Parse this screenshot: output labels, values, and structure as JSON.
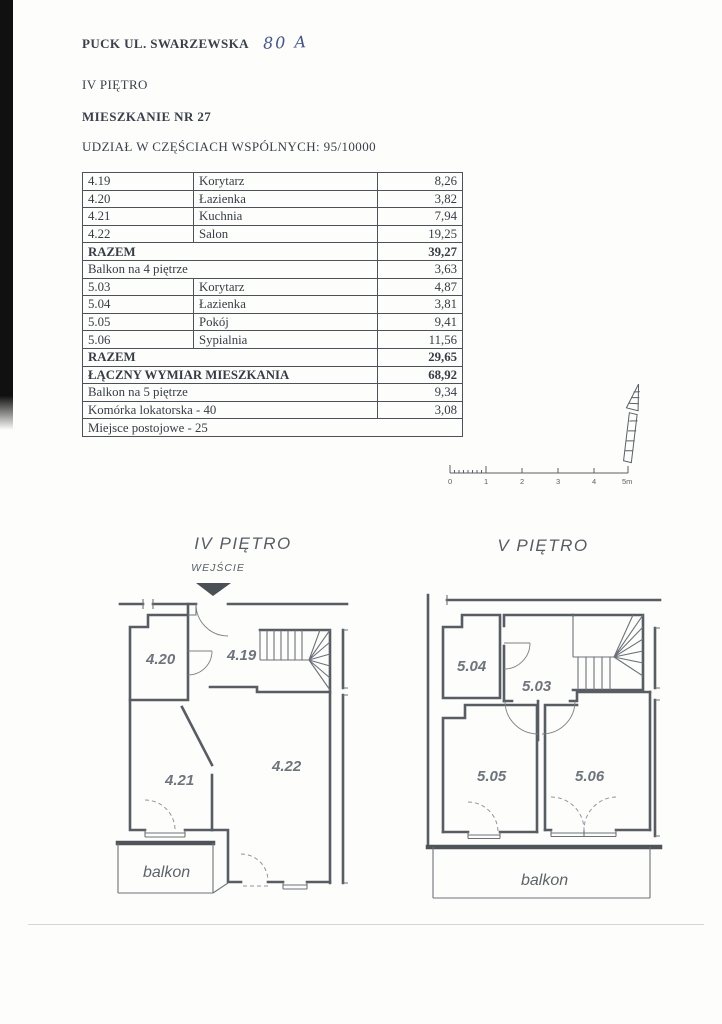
{
  "header": {
    "address_printed": "PUCK UL. SWARZEWSKA",
    "address_handwritten": "80 A",
    "floor_line": "IV PIĘTRO",
    "apartment_line": "MIESZKANIE NR 27",
    "share_line": "UDZIAŁ W CZĘŚCIACH WSPÓLNYCH: 95/10000"
  },
  "area_table": {
    "rows": [
      {
        "no": "4.19",
        "name": "Korytarz",
        "area": "8,26"
      },
      {
        "no": "4.20",
        "name": "Łazienka",
        "area": "3,82"
      },
      {
        "no": "4.21",
        "name": "Kuchnia",
        "area": "7,94"
      },
      {
        "no": "4.22",
        "name": "Salon",
        "area": "19,25"
      },
      {
        "label": "RAZEM",
        "area": "39,27"
      },
      {
        "label": "Balkon na 4 piętrze",
        "area": "3,63"
      },
      {
        "no": "5.03",
        "name": "Korytarz",
        "area": "4,87"
      },
      {
        "no": "5.04",
        "name": "Łazienka",
        "area": "3,81"
      },
      {
        "no": "5.05",
        "name": "Pokój",
        "area": "9,41"
      },
      {
        "no": "5.06",
        "name": "Sypialnia",
        "area": "11,56"
      },
      {
        "label": "RAZEM",
        "area": "29,65"
      },
      {
        "label": "ŁĄCZNY WYMIAR MIESZKANIA",
        "area": "68,92"
      },
      {
        "label": "Balkon na 5 piętrze",
        "area": "9,34"
      },
      {
        "label": "Komórka lokatorska - 40",
        "area": "3,08"
      },
      {
        "label": "Miejsce postojowe - 25"
      }
    ]
  },
  "scale_bar": {
    "ticks": [
      "0",
      "1",
      "2",
      "3",
      "4",
      "5m"
    ]
  },
  "plans": {
    "iv": {
      "title": "IV PIĘTRO",
      "entrance_label": "WEJŚCIE",
      "rooms": [
        "4.20",
        "4.19",
        "4.21",
        "4.22"
      ],
      "balcony_label": "balkon"
    },
    "v": {
      "title": "V PIĘTRO",
      "rooms": [
        "5.04",
        "5.03",
        "5.05",
        "5.06"
      ],
      "balcony_label": "balkon"
    }
  },
  "colors": {
    "ink": "#39404b",
    "plan_line": "#585d64",
    "handwriting_blue": "#44568e",
    "scan_bar": "#101010"
  }
}
